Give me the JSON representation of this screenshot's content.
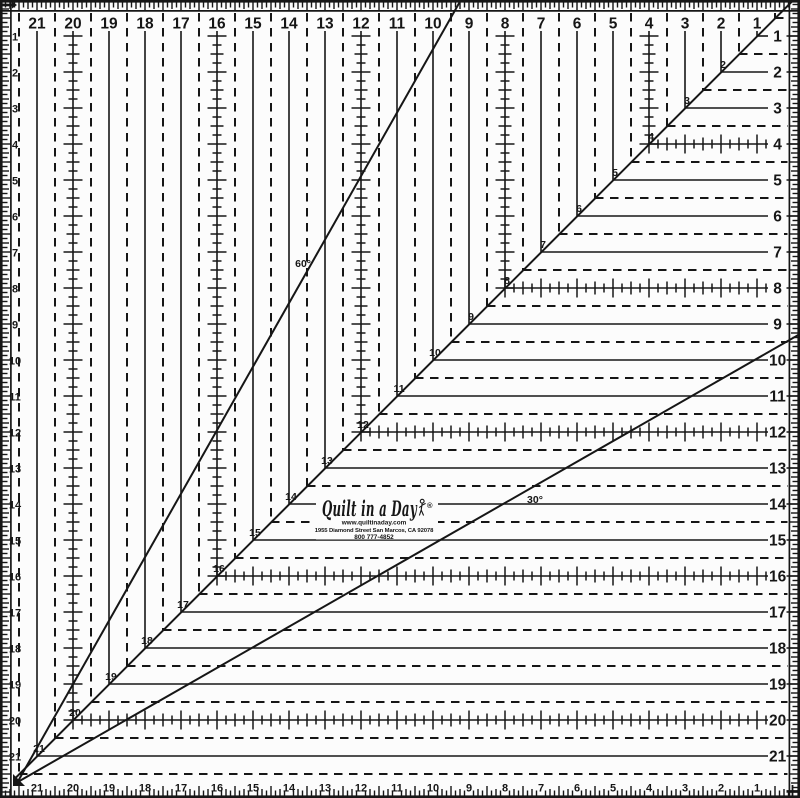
{
  "ruler": {
    "paper_color": "#fcfcfc",
    "ink_color": "#161616",
    "edge_numbers": {
      "top": [
        "21",
        "20",
        "19",
        "18",
        "17",
        "16",
        "15",
        "14",
        "13",
        "12",
        "11",
        "10",
        "9",
        "8",
        "7",
        "6",
        "5",
        "4",
        "3",
        "2",
        "1"
      ],
      "left": [
        "1",
        "2",
        "3",
        "4",
        "5",
        "6",
        "7",
        "8",
        "9",
        "10",
        "11",
        "12",
        "13",
        "14",
        "15",
        "16",
        "17",
        "18",
        "19",
        "20",
        "21"
      ],
      "right": [
        "1",
        "2",
        "3",
        "4",
        "5",
        "6",
        "7",
        "8",
        "9",
        "10",
        "11",
        "12",
        "13",
        "14",
        "15",
        "16",
        "17",
        "18",
        "19",
        "20",
        "21"
      ],
      "bottom": [
        "21",
        "20",
        "19",
        "18",
        "17",
        "16",
        "15",
        "14",
        "13",
        "12",
        "11",
        "10",
        "9",
        "8",
        "7",
        "6",
        "5",
        "4",
        "3",
        "2",
        "1"
      ]
    },
    "diagonal_point_labels": [
      "2",
      "3",
      "4",
      "5",
      "6",
      "7",
      "8",
      "9",
      "10",
      "11",
      "12",
      "13",
      "14",
      "15",
      "16",
      "17",
      "18",
      "19",
      "20",
      "21"
    ],
    "tick_marked_lines": [
      4,
      8,
      12,
      16,
      20
    ],
    "angle_labels": {
      "sixty": "60°",
      "thirty": "30°"
    },
    "logo": {
      "brand": "Quilt in a Day",
      "registered_mark": "®",
      "website": "www.quiltinaday.com",
      "address": "1955 Diamond Street San Marcos, CA 92078",
      "phone": "800 777-4852"
    }
  }
}
